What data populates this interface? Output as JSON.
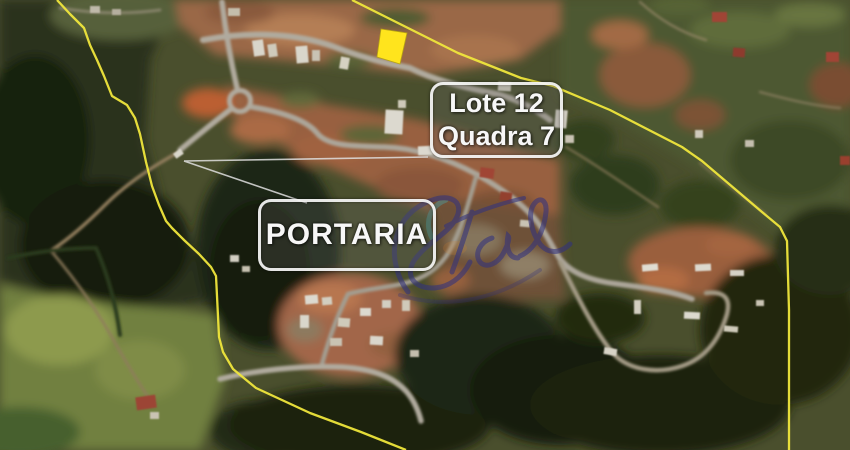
{
  "scene": {
    "type": "aerial-satellite-photo",
    "description": "Aerial photo of a gated residential land development with a highlighted lot, perimeter boundary and gatehouse annotation"
  },
  "annotations": {
    "lot_label": {
      "line1": "Lote 12",
      "line2": "Quadra 7"
    },
    "gate_label": {
      "text": "PORTARIA"
    },
    "highlighted_lot": {
      "color": "#ffe41d",
      "outline": "#b8a512"
    },
    "boundary": {
      "color": "#efe63c"
    },
    "leader_lines": {
      "color": "#e0e0e0"
    },
    "watermark": {
      "kind": "cursive-signature",
      "color": "#32327e",
      "accent": "#39bfcf"
    }
  }
}
